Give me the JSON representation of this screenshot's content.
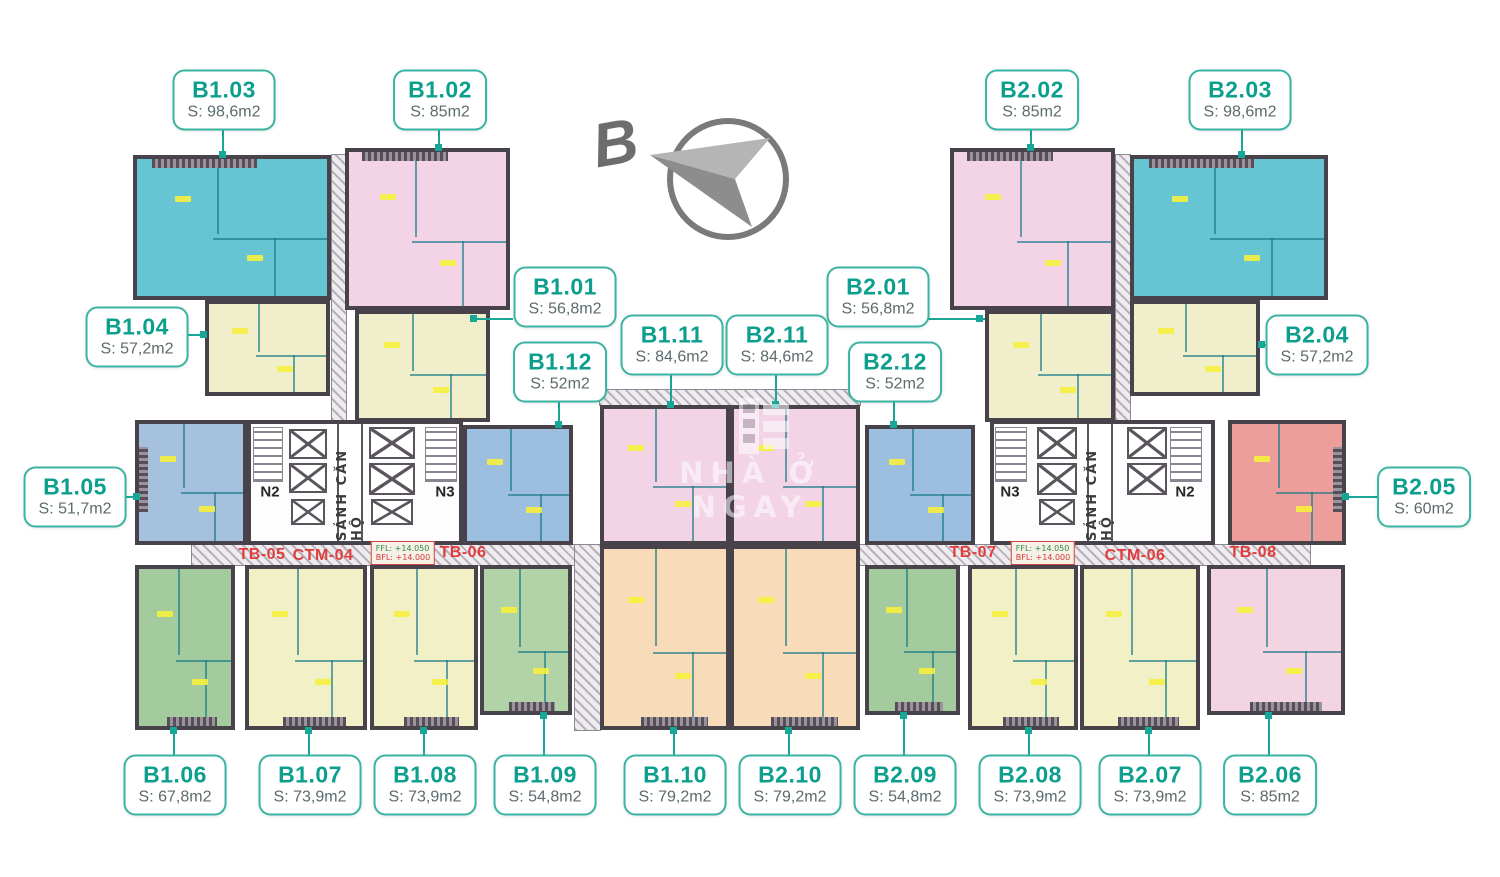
{
  "page": {
    "background": "#ffffff"
  },
  "compass": {
    "letter": "B"
  },
  "watermark": {
    "text": "NHÀ Ở NGAY",
    "logo": "building-logo"
  },
  "palette": {
    "label_text": "#0d9f8d",
    "label_border": "#3ab4a2",
    "area_text": "#5c6b6b",
    "connector_line": "#17a697",
    "wall": "#48434b",
    "corridor_label_red": "#e23d3d",
    "unit_teal": "#67c5d3",
    "unit_pink": "#f2d4e6",
    "unit_cream": "#f1efcb",
    "unit_blue": "#a2c0de",
    "unit_green": "#a4cb9d",
    "unit_yellow": "#f2f0c6",
    "unit_peach": "#f8dcba",
    "unit_salmon": "#ee9e9a"
  },
  "units": [
    {
      "code": "B1.01",
      "area": "S: 56,8m2",
      "color": "#f1efcb"
    },
    {
      "code": "B1.02",
      "area": "S: 85m2",
      "color": "#f2d4e6"
    },
    {
      "code": "B1.03",
      "area": "S: 98,6m2",
      "color": "#67c5d3"
    },
    {
      "code": "B1.04",
      "area": "S: 57,2m2",
      "color": "#f1efcb"
    },
    {
      "code": "B1.05",
      "area": "S: 51,7m2",
      "color": "#a5c1de"
    },
    {
      "code": "B1.06",
      "area": "S: 67,8m2",
      "color": "#a4cb9d"
    },
    {
      "code": "B1.07",
      "area": "S: 73,9m2",
      "color": "#f2f0c6"
    },
    {
      "code": "B1.08",
      "area": "S: 73,9m2",
      "color": "#f2f0c6"
    },
    {
      "code": "B1.09",
      "area": "S: 54,8m2",
      "color": "#b2d3a8"
    },
    {
      "code": "B1.10",
      "area": "S: 79,2m2",
      "color": "#f8dcba"
    },
    {
      "code": "B1.11",
      "area": "S: 84,6m2",
      "color": "#f2d4e6"
    },
    {
      "code": "B1.12",
      "area": "S: 52m2",
      "color": "#9dbfdf"
    },
    {
      "code": "B2.01",
      "area": "S: 56,8m2",
      "color": "#f1efcb"
    },
    {
      "code": "B2.02",
      "area": "S: 85m2",
      "color": "#f2d4e6"
    },
    {
      "code": "B2.03",
      "area": "S: 98,6m2",
      "color": "#67c5d3"
    },
    {
      "code": "B2.04",
      "area": "S: 57,2m2",
      "color": "#f1efcb"
    },
    {
      "code": "B2.05",
      "area": "S: 60m2",
      "color": "#ee9e9a"
    },
    {
      "code": "B2.06",
      "area": "S: 85m2",
      "color": "#f3d5e2"
    },
    {
      "code": "B2.07",
      "area": "S: 73,9m2",
      "color": "#f2f0c6"
    },
    {
      "code": "B2.08",
      "area": "S: 73,9m2",
      "color": "#f2f0c6"
    },
    {
      "code": "B2.09",
      "area": "S: 54,8m2",
      "color": "#a4cb9d"
    },
    {
      "code": "B2.10",
      "area": "S: 79,2m2",
      "color": "#f8dcba"
    },
    {
      "code": "B2.11",
      "area": "S: 84,6m2",
      "color": "#f2d4e6"
    },
    {
      "code": "B2.12",
      "area": "S: 52m2",
      "color": "#9dbfdf"
    }
  ],
  "cores": [
    {
      "lobby": "SẢNH CĂN HỘ",
      "stair_labels": [
        "N2",
        "N3"
      ]
    },
    {
      "lobby": "SẢNH CĂN HỘ",
      "stair_labels": [
        "N3",
        "N2"
      ]
    }
  ],
  "corridor": {
    "labels": [
      "TB-05",
      "CTM-04",
      "TB-06",
      "TB-07",
      "CTM-06",
      "TB-08"
    ],
    "level_boxes": [
      {
        "line1": "FFL: +14.050",
        "line2": "BFL: +14.000"
      },
      {
        "line1": "FFL: +14.050",
        "line2": "BFL: +14.000"
      }
    ]
  }
}
